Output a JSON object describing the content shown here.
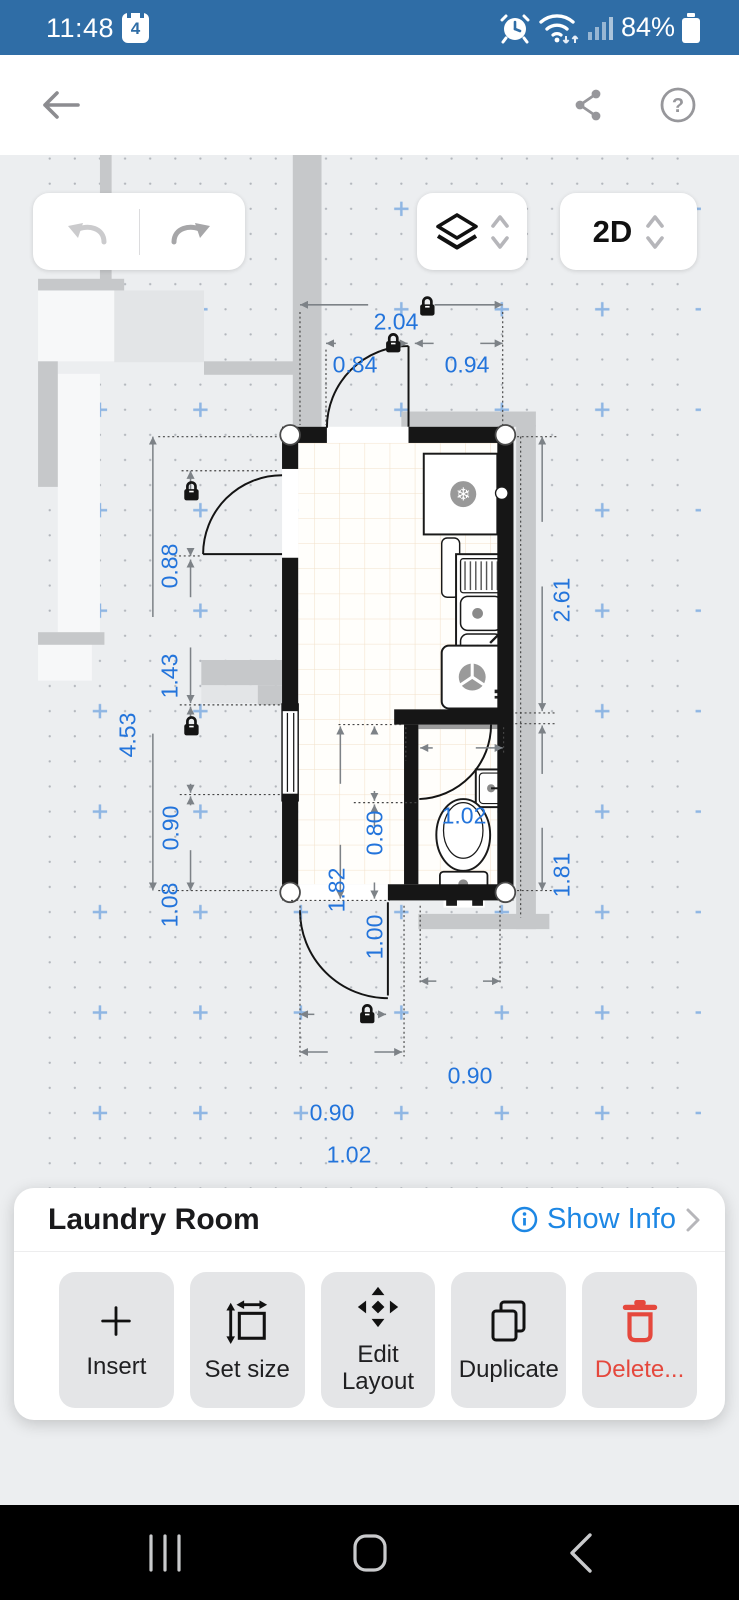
{
  "status_bar": {
    "time": "11:48",
    "notification_count": "4",
    "battery": "84%"
  },
  "toolbar": {
    "view_mode": "2D"
  },
  "plan": {
    "dims": {
      "top_total": "2.04",
      "top_door": "0.84",
      "top_right": "0.94",
      "left_total": "4.53",
      "left_door": "0.88",
      "left_mid": "1.43",
      "left_window": "0.90",
      "left_bottom": "1.08",
      "right_upper": "2.61",
      "right_lower": "1.81",
      "bath_width": "1.02",
      "inner_height": "1.82",
      "bath_upper": "0.80",
      "bath_lower": "1.00",
      "bottom_right": "0.90",
      "bottom_door": "0.90",
      "bottom_total": "1.02"
    },
    "fixtures": [
      "fridge",
      "sink",
      "washing-machine",
      "washbasin",
      "toilet"
    ]
  },
  "sheet": {
    "title": "Laundry Room",
    "show_info": "Show Info",
    "buttons": [
      {
        "label": "Insert",
        "icon": "plus"
      },
      {
        "label": "Set size",
        "icon": "resize"
      },
      {
        "label": "Edit Layout",
        "icon": "move"
      },
      {
        "label": "Duplicate",
        "icon": "copy"
      },
      {
        "label": "Delete...",
        "icon": "trash"
      }
    ]
  },
  "icons": {
    "back": "arrow-left",
    "share": "share-nodes",
    "help": "question-circle",
    "undo": "undo-arrow",
    "redo": "redo-arrow",
    "layers": "layers",
    "info": "info-circle",
    "chevron": "chevron-right",
    "lock": "padlock"
  },
  "colors": {
    "statusbar_blue": "#2f6da6",
    "dim_blue": "#2374db",
    "accent_blue": "#1d87e4",
    "delete_red": "#e5483d"
  }
}
